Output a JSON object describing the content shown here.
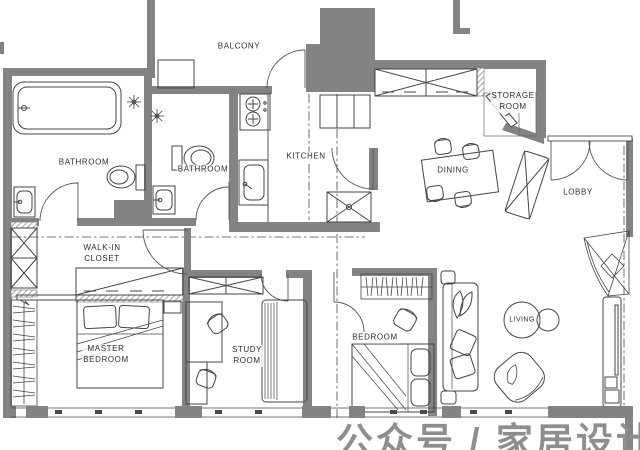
{
  "floor_plan": {
    "type": "apartment-floor-plan",
    "labels": {
      "balcony": "BALCONY",
      "bathroom_master": "BATHROOM",
      "bathroom_second": "BATHROOM",
      "kitchen": "KITCHEN",
      "storage_room": "STORAGE\nROOM",
      "dining": "DINING",
      "lobby": "LOBBY",
      "walk_in_closet": "WALK-IN\nCLOSET",
      "master_bedroom": "MASTER\nBEDROOM",
      "study_room": "STUDY\nROOM",
      "bedroom": "BEDROOM",
      "living": "LIVING"
    },
    "watermark": "公众号 / 家居设计案例",
    "colors": {
      "wall": "#838383",
      "line": "#454545",
      "background": "#ffffff",
      "watermark": "#8e8e8e"
    }
  }
}
